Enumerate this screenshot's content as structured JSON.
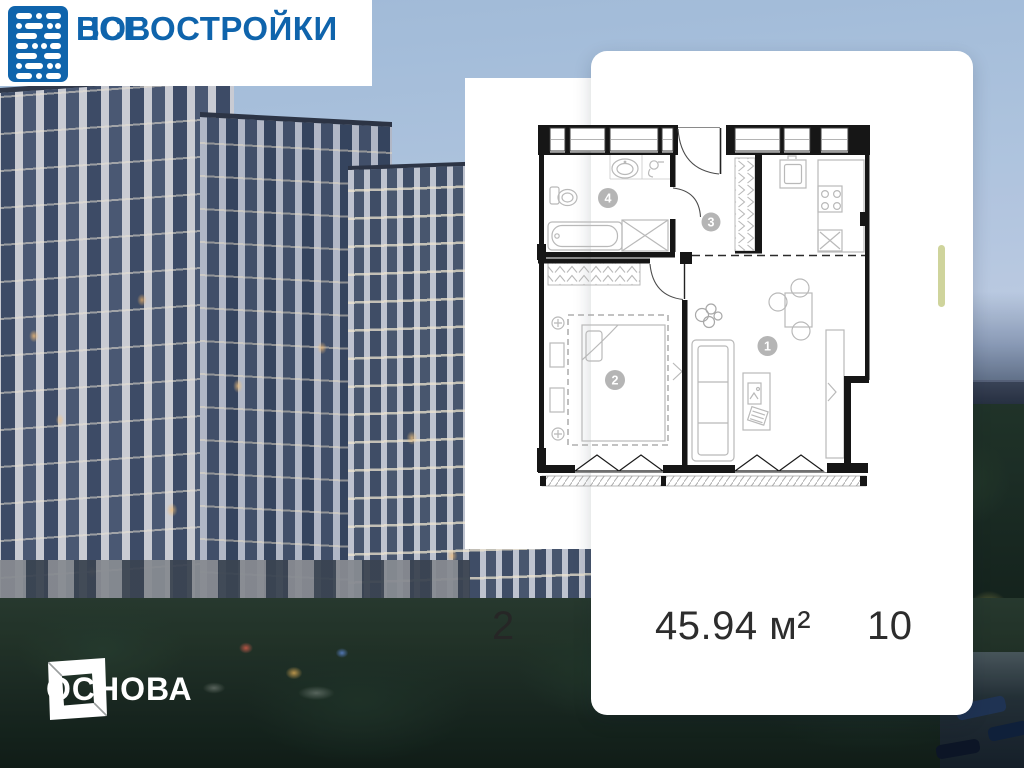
{
  "brand": {
    "line1": "ВСЕ",
    "line2": "НОВОСТРОЙКИ"
  },
  "developer": {
    "name": "ОСНОВА"
  },
  "listing": {
    "building_number": "2",
    "area": "45.94 м²",
    "floor": "10"
  },
  "floor_plan": {
    "rooms": [
      {
        "number": "1"
      },
      {
        "number": "2"
      },
      {
        "number": "3"
      },
      {
        "number": "4"
      }
    ]
  },
  "colors": {
    "logo_blue": "#0f64ac",
    "scroll_pill": "#cfd49c",
    "wall": "#161616",
    "fixture": "#b9b9b9"
  }
}
